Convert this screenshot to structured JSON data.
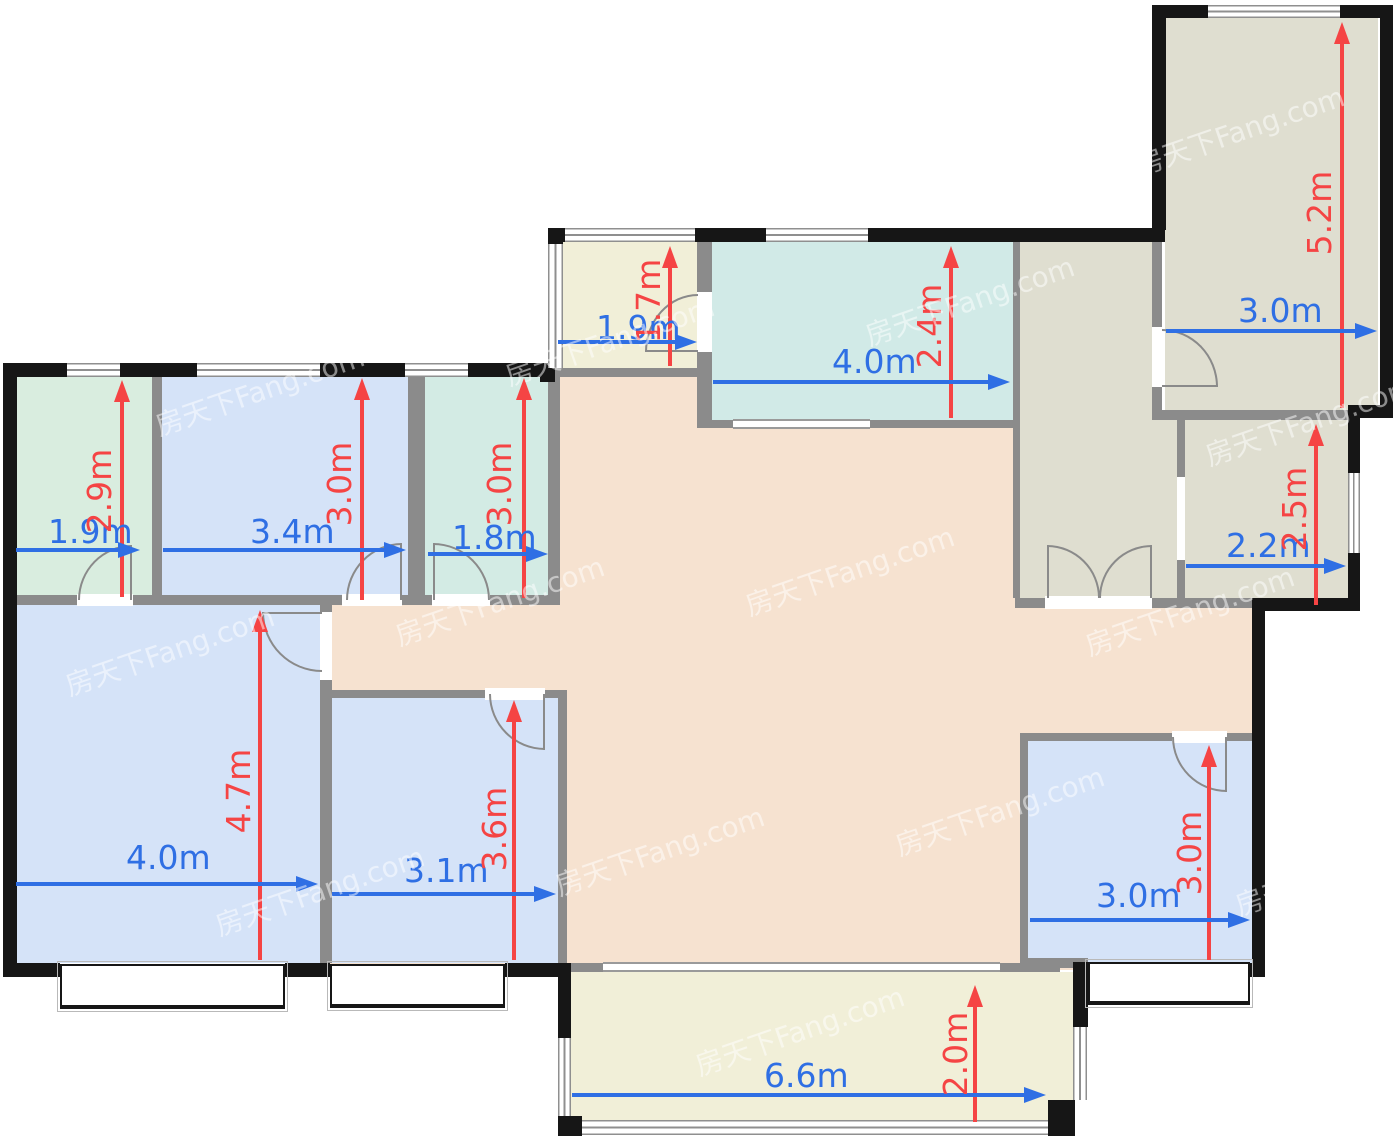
{
  "watermark": {
    "text": "房天下Fang.com"
  },
  "units": "m",
  "colors": {
    "dimension_red": "#f54444",
    "dimension_blue": "#2f6fe4",
    "interior_wall": "#8b8b8b",
    "outer_wall": "#161616",
    "mint_room": "#d9eddf",
    "blue_room": "#d5e3f8",
    "teal_room": "#d3ebe4",
    "cyan_room": "#d1eae7",
    "cream_room": "#f1efd8",
    "olive_room": "#dfded0",
    "living_peach": "#f6e2d0"
  },
  "rooms": [
    {
      "name": "bedroom-top-left",
      "w": "1.9m",
      "h": "2.9m",
      "fill": "#d9eddf"
    },
    {
      "name": "bedroom-top-mid-left",
      "w": "3.4m",
      "h": "3.0m",
      "fill": "#d5e3f8"
    },
    {
      "name": "bath-top",
      "w": "1.8m",
      "h": "3.0m",
      "fill": "#d3ebe4"
    },
    {
      "name": "entry-hall",
      "w": "1.9m",
      "h": "1.7m",
      "fill": "#f1efd8"
    },
    {
      "name": "dining-room",
      "w": "4.0m",
      "h": "2.4m",
      "fill": "#d1eae7"
    },
    {
      "name": "room-top-right",
      "w": "3.0m",
      "h": "5.2m",
      "fill": "#dfded0"
    },
    {
      "name": "room-mid-right",
      "w": "2.2m",
      "h": "2.5m",
      "fill": "#dfded0"
    },
    {
      "name": "master-bedroom",
      "w": "4.0m",
      "h": "4.7m",
      "fill": "#d5e3f8"
    },
    {
      "name": "bedroom-bottom-mid",
      "w": "3.1m",
      "h": "3.6m",
      "fill": "#d5e3f8"
    },
    {
      "name": "bedroom-bottom-right",
      "w": "3.0m",
      "h": "3.0m",
      "fill": "#d5e3f8"
    },
    {
      "name": "balcony",
      "w": "6.6m",
      "h": "2.0m",
      "fill": "#f1efd8"
    }
  ]
}
